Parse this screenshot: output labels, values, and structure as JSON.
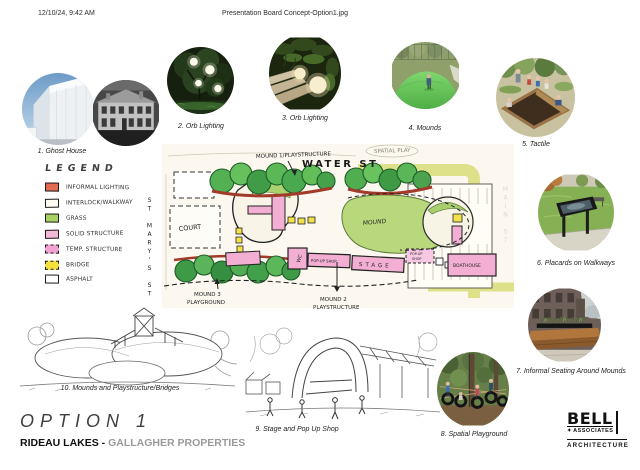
{
  "header": {
    "timestamp": "12/10/24, 9:42 AM",
    "filename": "Presentation Board Concept-Option1.jpg"
  },
  "gallery": [
    {
      "caption": "1. Ghost House"
    },
    {
      "caption": "2. Orb Lighting"
    },
    {
      "caption": "3. Orb Lighting"
    },
    {
      "caption": "4. Mounds"
    },
    {
      "caption": "5. Tactile"
    },
    {
      "caption": "6. Placards on Walkways"
    },
    {
      "caption": "7. Informal Seating Around Mounds"
    },
    {
      "caption": "8. Spatial Playground"
    }
  ],
  "sketches": {
    "stage_caption": "9. Stage and Pop Up Shop",
    "mounds_caption": "10. Mounds and Playstructure/Bridges"
  },
  "legend": {
    "title": "LEGEND",
    "items": [
      {
        "label": "INFORMAL LIGHTING",
        "color": "#e06a52",
        "border": "solid"
      },
      {
        "label": "INTERLOCK/WALKWAY",
        "color": "#fdfbf2",
        "border": "solid"
      },
      {
        "label": "GRASS",
        "color": "#a9d264",
        "border": "solid"
      },
      {
        "label": "SOLID STRUCTURE",
        "color": "#f3b8d8",
        "border": "solid"
      },
      {
        "label": "TEMP. STRUCTURE",
        "color": "#f2a3d2",
        "border": "dashed"
      },
      {
        "label": "BRIDGE",
        "color": "#f5e03c",
        "border": "dashed"
      },
      {
        "label": "ASPHALT",
        "color": "#ffffff",
        "border": "solid"
      }
    ]
  },
  "map": {
    "streets": {
      "water": "WATER ST",
      "main": "MAIN ST",
      "st_marys": "ST MARY'S ST"
    },
    "labels": {
      "mound1": "MOUND 1/PLAYSTRUCTURE",
      "mound2_line1": "MOUND 2",
      "mound2_line2": "PLAYSTRUCTURE",
      "mound3_line1": "MOUND 3",
      "mound3_line2": "PLAYGROUND",
      "spatial_play": "SPATIAL PLAY",
      "court": "COURT",
      "wc": "WC",
      "popup_shop": "POP-UP SHOP",
      "stage": "STAGE",
      "temp_popup_line1": "POP-UP",
      "temp_popup_line2": "SHOP",
      "boathouse": "BOATHOUSE",
      "parking": "PARKING",
      "mound": "MOUND"
    }
  },
  "footer": {
    "option": "OPTION 1",
    "project": "RIDEAU LAKES",
    "dash": " - ",
    "client": "GALLAGHER PROPERTIES"
  },
  "logo": {
    "bell": "BELL",
    "plus": "✦",
    "associates": "ASSOCIATES",
    "architecture": "ARCHITECTURE"
  }
}
